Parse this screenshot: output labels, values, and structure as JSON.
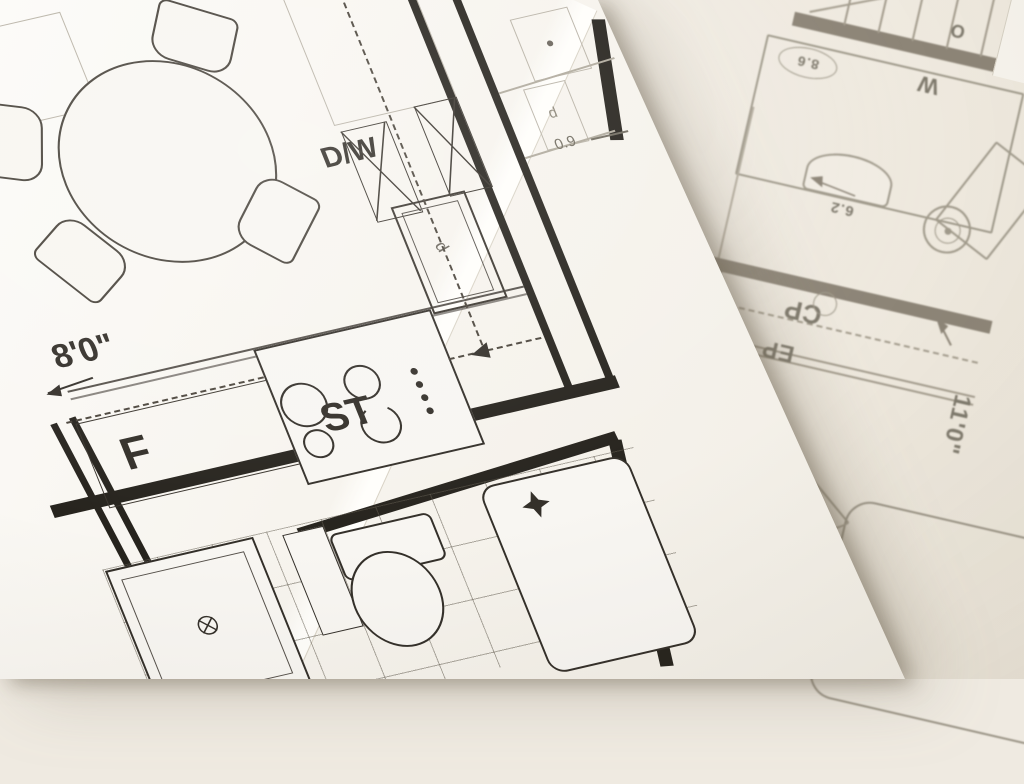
{
  "left_plan": {
    "labels": {
      "dishwasher": "D/W",
      "stove": "ST",
      "fridge": "F",
      "sink_d": "d",
      "cabinet_d": "d",
      "dim_counter": "8'0\"",
      "dim_small": "0.9"
    }
  },
  "right_plan": {
    "labels": {
      "closet": "CP",
      "entry": "EP",
      "dim_bedroom": "11'0\"",
      "dim_room": "10'0\"",
      "dim_a": "6.2",
      "dim_b": "8.6",
      "washer": "W",
      "other": "O"
    }
  },
  "colors": {
    "paper_top": "#f8f5f0",
    "paper_bottom": "#f1ece3",
    "ink_dark": "#33302a",
    "ink_wall": "#26231d",
    "ink_faint": "#b9b3a7",
    "ink_soft": "#8d8577",
    "edge_shadow": "rgba(110,98,80,0.45)"
  }
}
